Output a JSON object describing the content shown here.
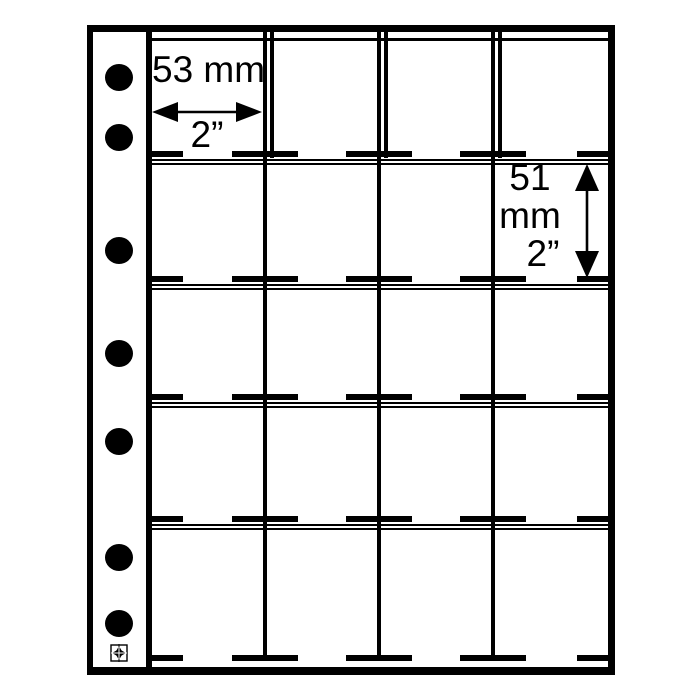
{
  "labels": {
    "pocket_width_mm": "53 mm",
    "pocket_width_in": "2”",
    "pocket_height_value": "51",
    "pocket_height_unit": "mm",
    "pocket_height_in": "2”"
  },
  "grid": {
    "rows": 5,
    "columns": 4,
    "pockets": 20,
    "binder_holes": 7
  },
  "colors": {
    "line": "#000000",
    "background": "#ffffff"
  }
}
